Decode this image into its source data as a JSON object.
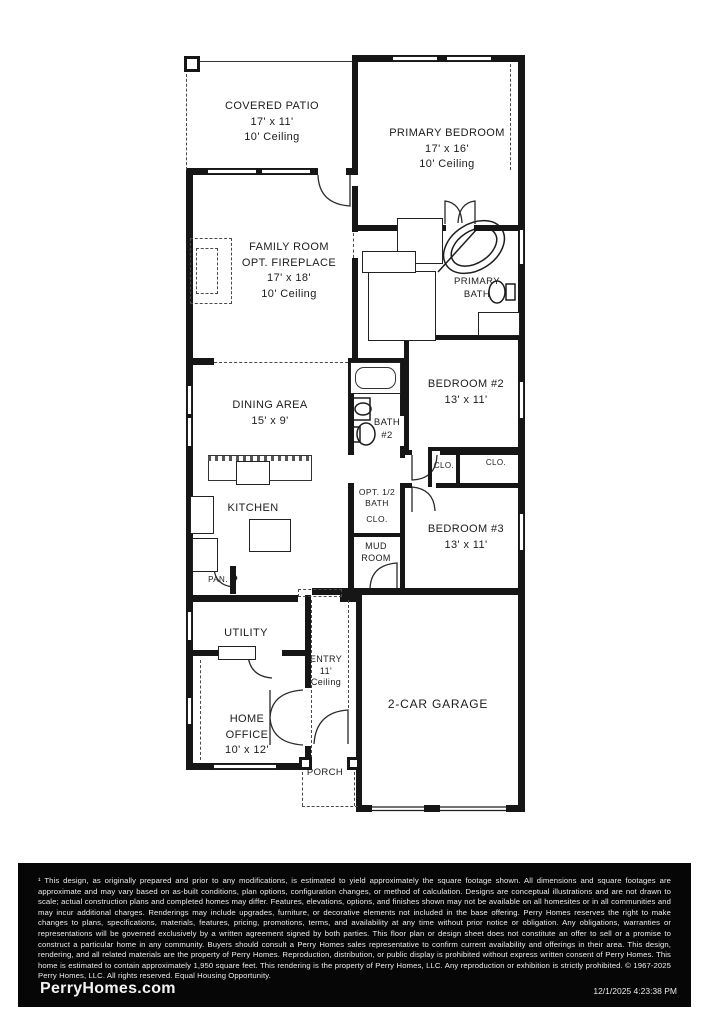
{
  "plan": {
    "covered_patio": {
      "name": "COVERED PATIO",
      "dims": "17' x 11'",
      "ceiling": "10' Ceiling"
    },
    "primary_bedroom": {
      "name": "PRIMARY BEDROOM",
      "dims": "17' x 16'",
      "ceiling": "10' Ceiling"
    },
    "family_room": {
      "name": "FAMILY ROOM",
      "option": "OPT. FIREPLACE",
      "dims": "17' x 18'",
      "ceiling": "10' Ceiling"
    },
    "linen": "LIN.",
    "primary_closet": "CLO.",
    "primary_bath": {
      "line1": "PRIMARY",
      "line2": "BATH"
    },
    "bedroom2": {
      "name": "BEDROOM #2",
      "dims": "13' x 11'"
    },
    "dining": {
      "name": "DINING AREA",
      "dims": "15' x 9'"
    },
    "bath2": {
      "line1": "BATH",
      "line2": "#2"
    },
    "closet_hall": "CLO.",
    "closet_bed2": "CLO.",
    "kitchen": "KITCHEN",
    "half_bath": {
      "line1": "OPT. 1/2",
      "line2": "BATH",
      "closet": "CLO."
    },
    "mud_room": {
      "line1": "MUD",
      "line2": "ROOM"
    },
    "bedroom3": {
      "name": "BEDROOM #3",
      "dims": "13' x 11'"
    },
    "pantry": "PAN.",
    "utility": "UTILITY",
    "entry": {
      "line1": "ENTRY",
      "line2": "11'",
      "line3": "Ceiling"
    },
    "home_office": {
      "line1": "HOME",
      "line2": "OFFICE",
      "dims": "10' x 12'"
    },
    "porch": "PORCH",
    "garage": "2-CAR GARAGE"
  },
  "footer": {
    "disclaimer": "¹ This design, as originally prepared and prior to any modifications, is estimated to yield approximately the square footage shown. All dimensions and square footages are approximate and may vary based on as-built conditions, plan options, configuration changes, or method of calculation. Designs are conceptual illustrations and are not drawn to scale; actual construction plans and completed homes may differ. Features, elevations, options, and finishes shown may not be available on all homesites or in all communities and may incur additional charges. Renderings may include upgrades, furniture, or decorative elements not included in the base offering. Perry Homes reserves the right to make changes to plans, specifications, materials, features, pricing, promotions, terms, and availability at any time without prior notice or obligation. Any obligations, warranties or representations will be governed exclusively by a written agreement signed by both parties. This floor plan or design sheet does not constitute an offer to sell or a promise to construct a particular home in any community. Buyers should consult a Perry Homes sales representative to confirm current availability and offerings in their area. This design, rendering, and all related materials are the property of Perry Homes. Reproduction, distribution, or public display is prohibited without express written consent of Perry Homes. This home is estimated to contain approximately 1,950 square feet. This rendering is the property of Perry Homes, LLC. Any reproduction or exhibition is strictly prohibited. © 1967-2025 Perry Homes, LLC. All rights reserved. Equal Housing Opportunity.",
    "website": "PerryHomes.com",
    "timestamp": "12/1/2025 4:23:38 PM"
  }
}
